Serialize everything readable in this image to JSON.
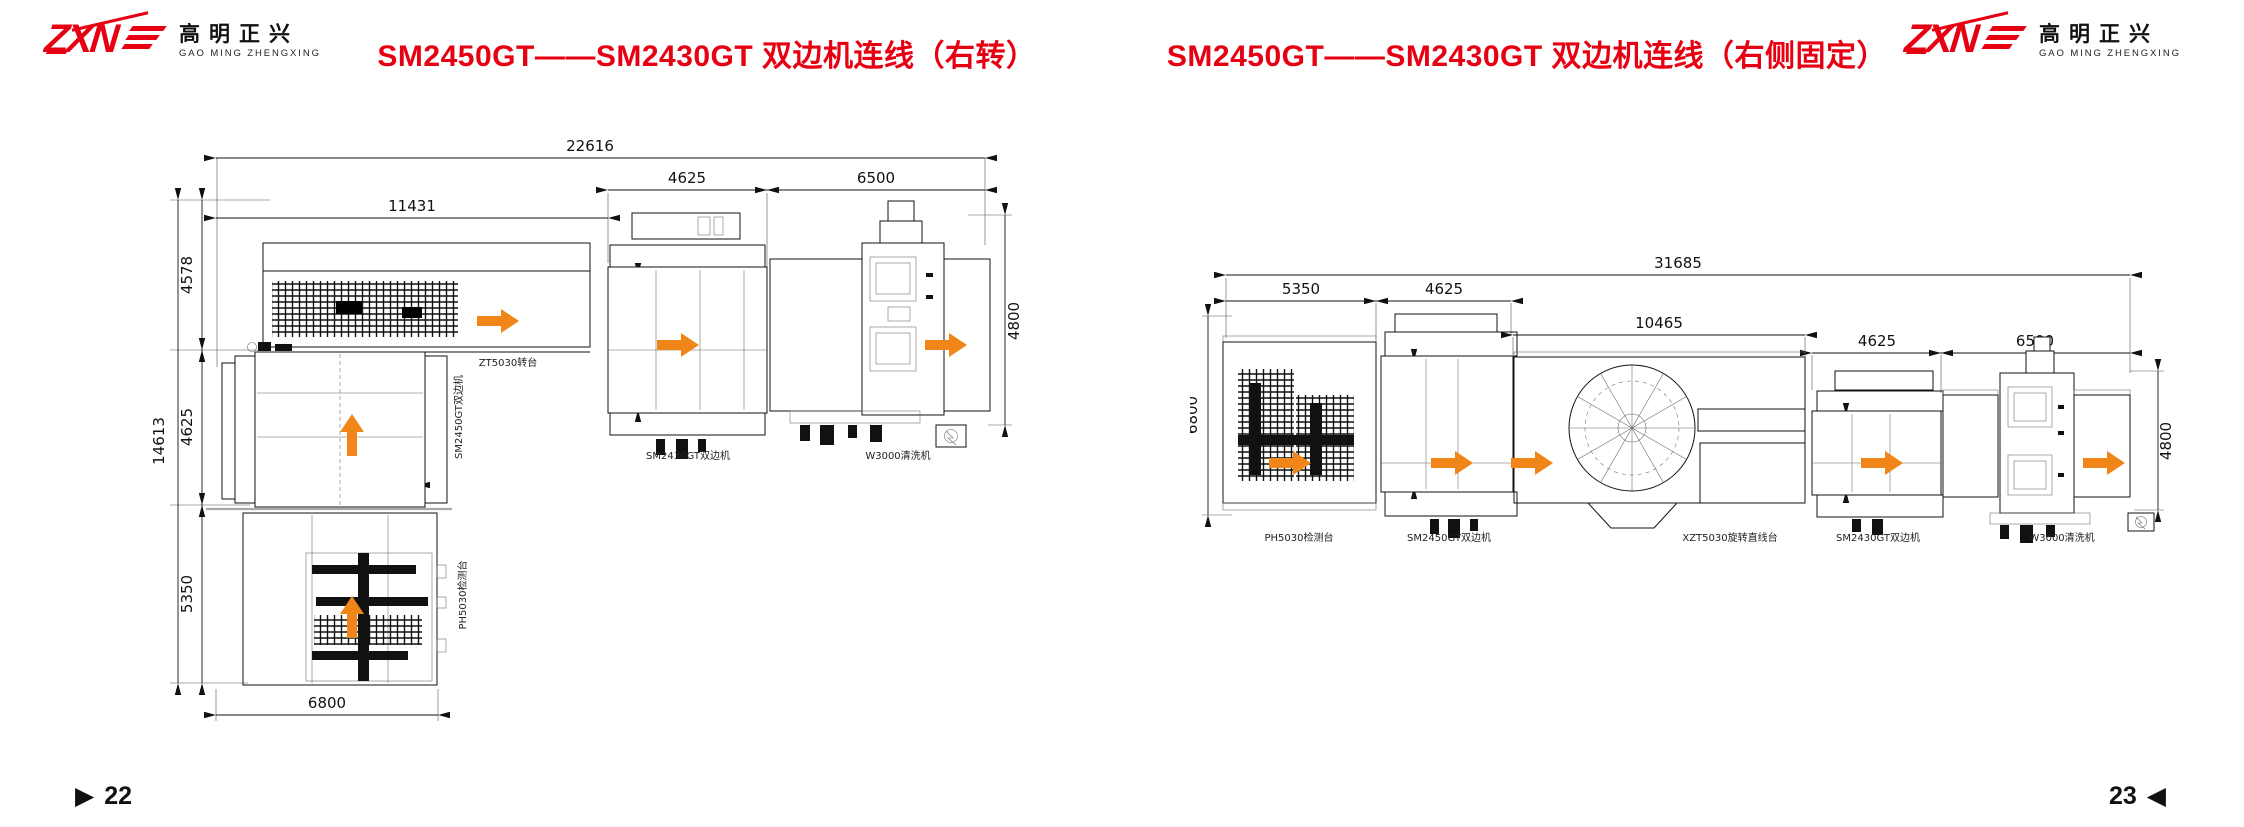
{
  "page": {
    "left_marker": "▶",
    "left_number": "22",
    "right_number": "23",
    "right_marker": "◀",
    "accent_red": "#e60012",
    "arrow_orange": "#f08619"
  },
  "logo": {
    "mark": "ZXN",
    "cn": "高明正兴",
    "en": "GAO MING ZHENGXING"
  },
  "left_panel": {
    "title": "SM2450GT——SM2430GT 双边机连线（右转）",
    "dims": {
      "total_width": "22616",
      "infeed_width": "11431",
      "edger2_width": "4625",
      "washer_width": "6500",
      "edger2_glass": "3000",
      "washer_height": "4800",
      "total_depth": "14613",
      "turntable_depth": "4578",
      "edger1_depth": "4625",
      "inspect_depth": "5350",
      "edger1_glass": "5000",
      "inspect_width": "6800"
    },
    "labels": {
      "turntable": "ZT5030转台",
      "edger1": "SM2450GT双边机",
      "inspect": "PH5030检测台",
      "edger2": "SM2430GT双边机",
      "washer": "W3000清洗机"
    }
  },
  "right_panel": {
    "title": "SM2450GT——SM2430GT 双边机连线（右侧固定）",
    "dims": {
      "total_width": "31685",
      "inspect_width": "5350",
      "edger1_width": "4625",
      "rotary_width": "10465",
      "edger2_width": "4625",
      "washer_width": "6500",
      "inspect_depth": "6800",
      "edger1_glass": "5000",
      "edger2_glass": "3000",
      "washer_height": "4800"
    },
    "labels": {
      "inspect": "PH5030检测台",
      "edger1": "SM2450GT双边机",
      "rotary": "XZT5030旋转直线台",
      "edger2": "SM2430GT双边机",
      "washer": "W3000清洗机"
    }
  }
}
